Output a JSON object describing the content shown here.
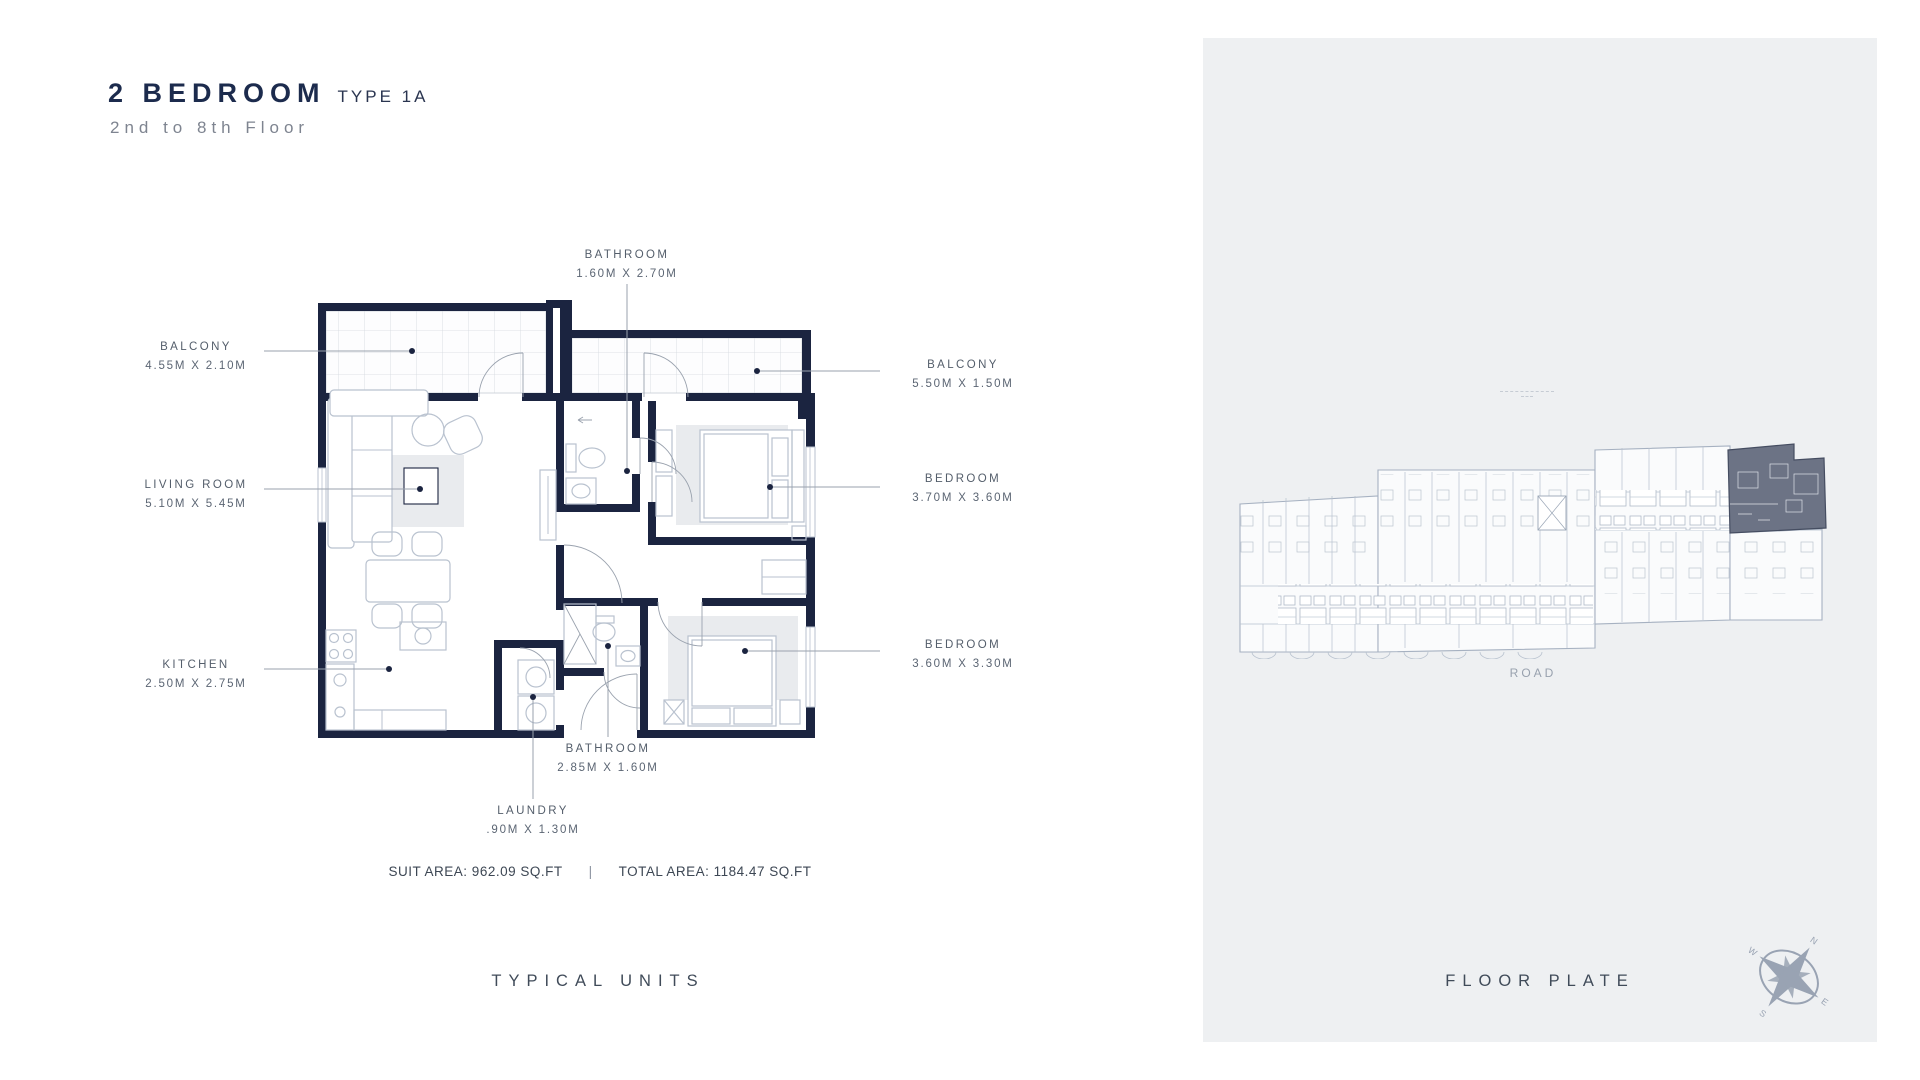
{
  "title": {
    "main": "2 BEDROOM",
    "type": "TYPE 1A",
    "floors": "2nd to 8th Floor"
  },
  "unit_plan": {
    "rooms": [
      {
        "id": "bathroom-top",
        "name": "BATHROOM",
        "dims": "1.60M X 2.70M"
      },
      {
        "id": "balcony-left",
        "name": "BALCONY",
        "dims": "4.55M X 2.10M"
      },
      {
        "id": "balcony-right",
        "name": "BALCONY",
        "dims": "5.50M X 1.50M"
      },
      {
        "id": "living-room",
        "name": "LIVING ROOM",
        "dims": "5.10M X 5.45M"
      },
      {
        "id": "bedroom-top",
        "name": "BEDROOM",
        "dims": "3.70M X 3.60M"
      },
      {
        "id": "kitchen",
        "name": "KITCHEN",
        "dims": "2.50M X 2.75M"
      },
      {
        "id": "bedroom-bottom",
        "name": "BEDROOM",
        "dims": "3.60M X 3.30M"
      },
      {
        "id": "bathroom-bottom",
        "name": "BATHROOM",
        "dims": "2.85M X 1.60M"
      },
      {
        "id": "laundry",
        "name": "LAUNDRY",
        "dims": ".90M X 1.30M"
      }
    ],
    "areas": {
      "suit": "SUIT AREA: 962.09 SQ.FT",
      "separator": "|",
      "total": "TOTAL AREA: 1184.47 SQ.FT"
    },
    "caption": "TYPICAL UNITS"
  },
  "floor_plate": {
    "caption": "FLOOR PLATE",
    "road_label": "ROAD",
    "compass": {
      "n": "N",
      "e": "E",
      "s": "S",
      "w": "W"
    }
  },
  "colors": {
    "wall": "#1b2440",
    "title_navy": "#1c2b4d",
    "muted_text": "#7e8490",
    "panel_bg": "#eef0f2",
    "plan_line": "#b9c2cf",
    "highlight_unit": "#6c7385"
  }
}
